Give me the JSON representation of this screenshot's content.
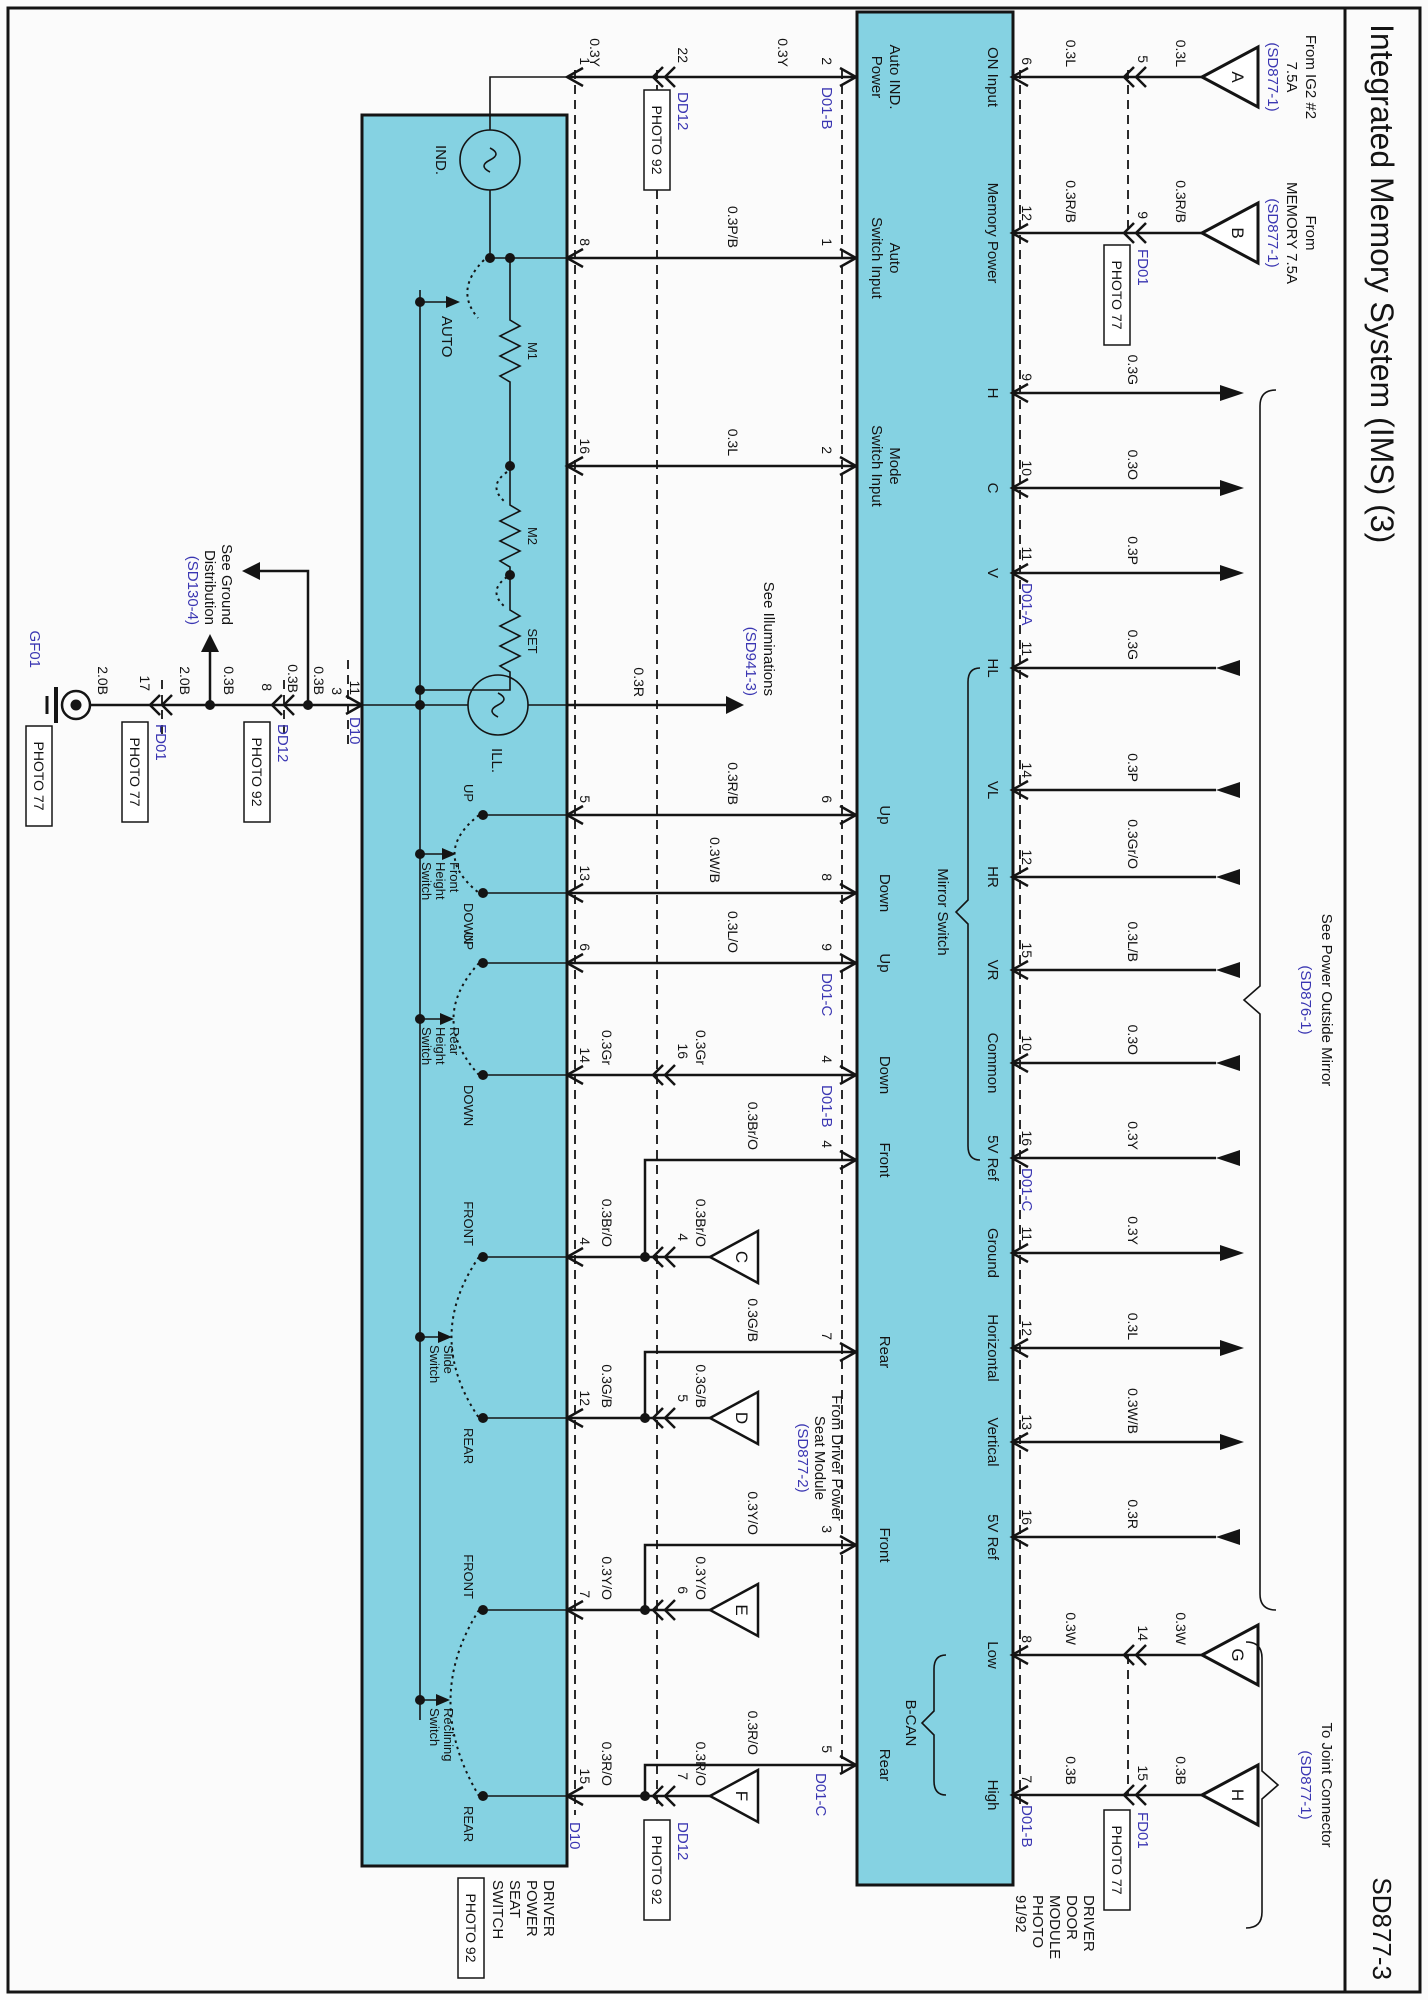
{
  "title": "Integrated Memory System (IMS) (3)",
  "page_code": "SD877-3",
  "colors": {
    "band": "#85d2e2",
    "ref_blue": "#3a36b2",
    "line": "#141414"
  },
  "door_module": {
    "label_lines": [
      "DRIVER",
      "DOOR",
      "MODULE",
      "PHOTO",
      "91/92"
    ],
    "mirror_switch_label": "Mirror Switch",
    "bcan_label": "B-CAN"
  },
  "seat_switch": {
    "label_lines": [
      "DRIVER",
      "POWER",
      "SEAT",
      "SWITCH"
    ],
    "photo": "PHOTO 92"
  },
  "refs": {
    "ig2": {
      "l1": "From IG2 #2",
      "l2": "7.5A",
      "l3": "(SD877-1)"
    },
    "memory": {
      "l1": "From",
      "l2": "MEMORY 7.5A",
      "l3": "(SD877-1)"
    },
    "mirror": {
      "l1": "See Power Outside Mirror",
      "l2": "(SD876-1)"
    },
    "joint": {
      "l1": "To Joint Connector",
      "l2": "(SD877-1)"
    },
    "illum": {
      "l1": "See Illuminations",
      "l2": "(SD941-3)"
    },
    "ground_dist": {
      "l1": "See Ground",
      "l2": "Distribution",
      "l3": "(SD130-4)"
    },
    "seat_module": {
      "l1": "From Driver Power",
      "l2": "Seat Module",
      "l3": "(SD877-2)"
    }
  },
  "connectors": {
    "fd01": "FD01",
    "dd12": "DD12",
    "d10": "D10",
    "gf01": "GF01",
    "photo77": "PHOTO 77",
    "photo92": "PHOTO 92",
    "d01a": "D01-A",
    "d01b": "D01-B",
    "d01c": "D01-C"
  },
  "triangles": {
    "a": "A",
    "b": "B",
    "c": "C",
    "d": "D",
    "e": "E",
    "f": "F",
    "g": "G",
    "h": "H"
  },
  "top_rows": [
    {
      "label": "ON Input",
      "pin": "6",
      "color1": "0.3L",
      "color2": "0.3L",
      "cpin": "5"
    },
    {
      "label": "Memory Power",
      "pin": "12",
      "color1": "0.3R/B",
      "color2": "0.3R/B",
      "cpin": "9"
    },
    {
      "label": "H",
      "pin": "9",
      "color": "0.3G"
    },
    {
      "label": "C",
      "pin": "10",
      "color": "0.3O"
    },
    {
      "label": "V",
      "pin": "11",
      "color": "0.3P",
      "tag": "D01-A"
    },
    {
      "label": "HL",
      "pin": "11",
      "color": "0.3G"
    },
    {
      "label": "VL",
      "pin": "14",
      "color": "0.3P"
    },
    {
      "label": "HR",
      "pin": "12",
      "color": "0.3Gr/O"
    },
    {
      "label": "VR",
      "pin": "15",
      "color": "0.3L/B"
    },
    {
      "label": "Common",
      "pin": "10",
      "color": "0.3O"
    },
    {
      "label": "5V Ref",
      "pin": "16",
      "color": "0.3Y",
      "tag": "D01-C"
    },
    {
      "label": "Ground",
      "pin": "11",
      "color": "0.3Y"
    },
    {
      "label": "Horizontal",
      "pin": "12",
      "color": "0.3L"
    },
    {
      "label": "Vertical",
      "pin": "13",
      "color": "0.3W/B"
    },
    {
      "label": "5V Ref",
      "pin": "16",
      "color": "0.3R"
    },
    {
      "label": "Low",
      "pin": "8",
      "color1": "0.3W",
      "color2": "0.3W",
      "cpin": "14"
    },
    {
      "label": "High",
      "pin": "7",
      "color1": "0.3B",
      "color2": "0.3B",
      "cpin": "15",
      "tag": "D01-B"
    }
  ],
  "bottom_rows": [
    {
      "l1": "Auto IND.",
      "l2": "Power",
      "pin": "2",
      "tag": "D01-B",
      "color1": "0.3Y",
      "color2": "0.3Y",
      "cpin": "22",
      "spin": "1"
    },
    {
      "l1": "Auto",
      "l2": "Switch Input",
      "pin": "1",
      "color": "0.3P/B",
      "spin": "8"
    },
    {
      "l1": "Mode",
      "l2": "Switch Input",
      "pin": "2",
      "color": "0.3L",
      "spin": "16"
    },
    {
      "l1": "Up",
      "pin": "6",
      "color": "0.3R/B",
      "spin": "5"
    },
    {
      "l1": "Down",
      "pin": "8",
      "color": "0.3W/B",
      "spin": "13"
    },
    {
      "l1": "Up",
      "pin": "9",
      "tag": "D01-C",
      "color": "0.3L/O",
      "spin": "6"
    },
    {
      "l1": "Down",
      "pin": "4",
      "tag": "D01-B",
      "color1": "0.3Gr",
      "color2": "0.3Gr",
      "cpin": "16",
      "spin": "14"
    },
    {
      "l1": "Front",
      "pin": "4",
      "colorb": "0.3Br/O",
      "color1": "0.3Br/O",
      "color2": "0.3Br/O",
      "cpin": "4",
      "spin": "4",
      "tri": "C"
    },
    {
      "l1": "Rear",
      "pin": "7",
      "colorb": "0.3G/B",
      "color1": "0.3G/B",
      "color2": "0.3G/B",
      "cpin": "5",
      "spin": "12",
      "tri": "D"
    },
    {
      "l1": "Front",
      "pin": "3",
      "colorb": "0.3Y/O",
      "color1": "0.3Y/O",
      "color2": "0.3Y/O",
      "cpin": "6",
      "spin": "7",
      "tri": "E"
    },
    {
      "l1": "Rear",
      "pin": "5",
      "tag": "D01-C",
      "colorb": "0.3R/O",
      "color1": "0.3R/O",
      "color2": "0.3R/O",
      "cpin": "7",
      "spin": "15",
      "tri": "F"
    }
  ],
  "ground_chain": {
    "pin": "3",
    "d10_pin": "11",
    "w1": "0.3B",
    "w2": "0.3B",
    "w3": "0.3B",
    "cpin1": "8",
    "w4": "2.0B",
    "cpin2": "17",
    "w5": "2.0B",
    "illum_color": "0.3R"
  },
  "switch_labels": {
    "ind": "IND.",
    "ill": "ILL.",
    "auto": "AUTO",
    "m1": "M1",
    "m2": "M2",
    "set": "SET",
    "fh": {
      "up": "UP",
      "down": "DOWN",
      "l1": "Front",
      "l2": "Height",
      "l3": "Switch"
    },
    "rh": {
      "up": "UP",
      "down": "DOWN",
      "l1": "Rear",
      "l2": "Height",
      "l3": "Switch"
    },
    "sl": {
      "front": "FRONT",
      "rear": "REAR",
      "l1": "Slide",
      "l2": "Switch"
    },
    "rc": {
      "front": "FRONT",
      "rear": "REAR",
      "l1": "Reclining",
      "l2": "Switch"
    }
  }
}
